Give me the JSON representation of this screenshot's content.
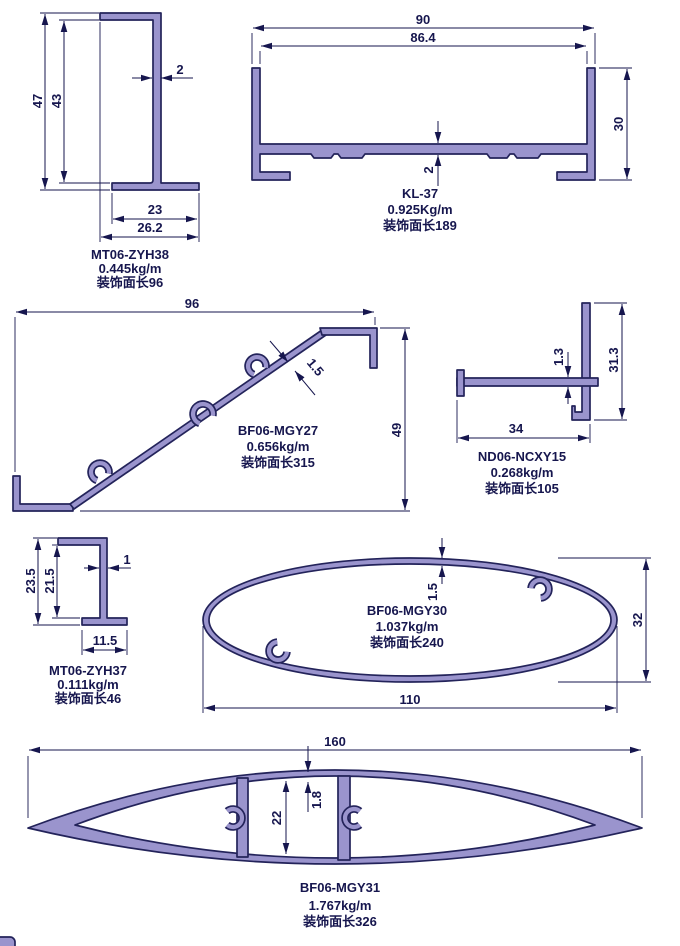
{
  "drawing": {
    "title": "aluminium-profile-cross-sections",
    "colors": {
      "profile_fill": "#9a94cd",
      "outline": "#23235a",
      "dimension": "#16164e",
      "background": "#ffffff"
    },
    "profiles": [
      {
        "model": "MT06-ZYH38",
        "weight": "0.445kg/m",
        "decor": "装饰面长96",
        "dims": {
          "overall_h": "47",
          "inner_h": "43",
          "thickness": "2",
          "flange_w": "23",
          "overall_w": "26.2"
        }
      },
      {
        "model": "KL-37",
        "weight": "0.925Kg/m",
        "decor": "装饰面长189",
        "dims": {
          "overall_w": "90",
          "inner_w": "86.4",
          "height": "30",
          "thickness": "2"
        }
      },
      {
        "model": "BF06-MGY27",
        "weight": "0.656kg/m",
        "decor": "装饰面长315",
        "dims": {
          "width": "96",
          "height": "49",
          "thickness": "1.5"
        }
      },
      {
        "model": "ND06-NCXY15",
        "weight": "0.268kg/m",
        "decor": "装饰面长105",
        "dims": {
          "bar_t": "1.3",
          "height": "31.3",
          "width": "34"
        }
      },
      {
        "model": "MT06-ZYH37",
        "weight": "0.111kg/m",
        "decor": "装饰面长46",
        "dims": {
          "overall_h": "23.5",
          "inner_h": "21.5",
          "thickness": "1",
          "width": "11.5"
        }
      },
      {
        "model": "BF06-MGY30",
        "weight": "1.037kg/m",
        "decor": "装饰面长240",
        "dims": {
          "thickness": "1.5",
          "height": "32",
          "width": "110"
        }
      },
      {
        "model": "BF06-MGY31",
        "weight": "1.767kg/m",
        "decor": "装饰面长326",
        "dims": {
          "thickness": "1.8",
          "height": "22",
          "width": "160"
        }
      }
    ]
  }
}
